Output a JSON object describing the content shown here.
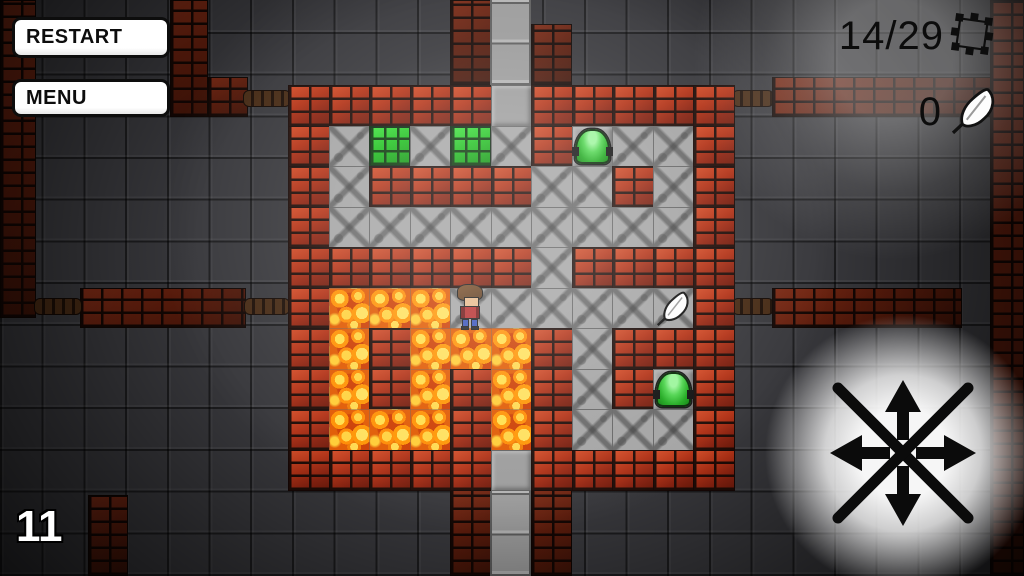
{
  "hud": {
    "restart_label": "RESTART",
    "menu_label": "MENU",
    "trap_counter": "14/29",
    "feather_counter": "0",
    "level": "11",
    "icons": [
      "trap-icon",
      "feather-icon"
    ]
  },
  "maze": {
    "origin_x": 288,
    "origin_y": 85,
    "tile": 40.5,
    "cols": 11,
    "rows": 10,
    "legend": {
      "W": "brick-wall-tile",
      "F": "stone-floor-tile",
      "G": "smooth-floor-tile",
      "L": "lava-tile",
      "P": "plant-tile",
      "J": "jelly-floor-tile"
    },
    "map": [
      "WWWWWGWWWWW",
      "WFPFPFWJFFW",
      "WFWWWWFFWFW",
      "WFFFFFFFFFW",
      "WWWWWWFWWWW",
      "WLLLFFFFFFW",
      "WLWLLLWFWWW",
      "WLWLWLWFWJW",
      "WLLLWLWFFFW",
      "WWWWWGWWWWW"
    ]
  },
  "objects": {
    "player": {
      "row": 5,
      "col": 4
    },
    "feather_pickup": {
      "row": 5,
      "col": 9
    },
    "jellies": [
      {
        "row": 1,
        "col": 7
      },
      {
        "row": 7,
        "col": 9
      }
    ]
  },
  "background": {
    "structures": [
      {
        "kind": "brick-column",
        "x": 0,
        "y": 0,
        "w": 36,
        "h": 318
      },
      {
        "kind": "brick-column",
        "x": 170,
        "y": 0,
        "w": 38,
        "h": 117
      },
      {
        "kind": "brick-wall",
        "x": 208,
        "y": 77,
        "w": 40,
        "h": 40
      },
      {
        "kind": "chain",
        "x": 243,
        "y": 90,
        "w": 48,
        "h": 17
      },
      {
        "kind": "brick-wall",
        "x": 80,
        "y": 288,
        "w": 166,
        "h": 40
      },
      {
        "kind": "chain",
        "x": 34,
        "y": 298,
        "w": 48,
        "h": 17
      },
      {
        "kind": "chain",
        "x": 244,
        "y": 298,
        "w": 46,
        "h": 17
      },
      {
        "kind": "brick-column",
        "x": 450,
        "y": 0,
        "w": 41,
        "h": 85
      },
      {
        "kind": "smooth-corridor",
        "x": 490,
        "y": 0,
        "w": 41,
        "h": 85
      },
      {
        "kind": "brick-column",
        "x": 531,
        "y": 24,
        "w": 41,
        "h": 61
      },
      {
        "kind": "chain",
        "x": 732,
        "y": 90,
        "w": 42,
        "h": 17
      },
      {
        "kind": "brick-wall",
        "x": 772,
        "y": 77,
        "w": 252,
        "h": 40
      },
      {
        "kind": "brick-column",
        "x": 990,
        "y": 0,
        "w": 34,
        "h": 576
      },
      {
        "kind": "chain",
        "x": 732,
        "y": 298,
        "w": 42,
        "h": 17
      },
      {
        "kind": "brick-wall",
        "x": 772,
        "y": 288,
        "w": 190,
        "h": 40
      },
      {
        "kind": "brick-column",
        "x": 450,
        "y": 490,
        "w": 41,
        "h": 86
      },
      {
        "kind": "smooth-corridor",
        "x": 490,
        "y": 490,
        "w": 41,
        "h": 86
      },
      {
        "kind": "brick-column",
        "x": 531,
        "y": 490,
        "w": 41,
        "h": 86
      },
      {
        "kind": "brick-column",
        "x": 88,
        "y": 495,
        "w": 40,
        "h": 81
      }
    ]
  },
  "dpad": {
    "cx": 903,
    "cy": 453,
    "directions": [
      "up",
      "down",
      "left",
      "right"
    ]
  },
  "colors": {
    "brick_lit": "#b23216",
    "brick_dark": "#5c1c0c",
    "floor": "#a4a4a4",
    "lava": "#ff8a00",
    "plant": "#1cc01c",
    "jelly": "#2db52d",
    "glow": "#ffffff",
    "hud_text": "#0c0c0c",
    "level_text": "#ffffff"
  }
}
